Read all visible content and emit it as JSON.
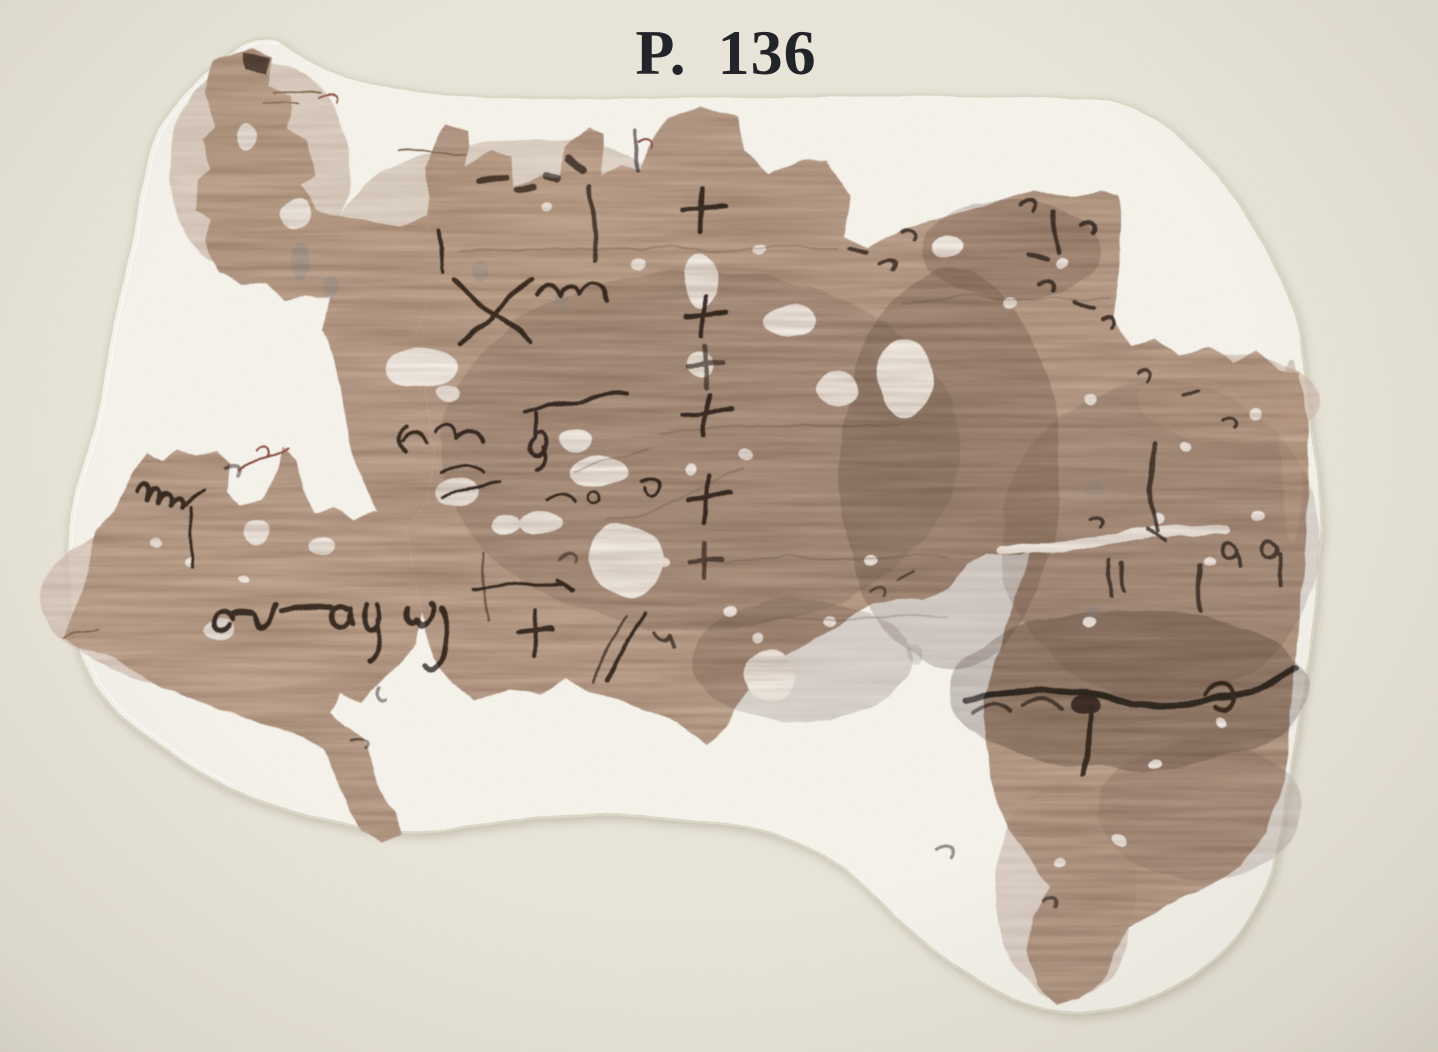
{
  "plate": {
    "title": "P. 136"
  },
  "artifact": {
    "label": "papyrus fragment with greek cursive ink traces",
    "mount_label": "white mounting sheet",
    "background_label": "cream plate paper"
  },
  "colors": {
    "background": "#eae6da",
    "mount": "#f6f4ec",
    "mount_edge": "#dedaca",
    "mount_shadow": "#a9a291",
    "papyrus_base": "#bfa893",
    "papyrus_light": "#cdb69e",
    "papyrus_dark": "#6e5646",
    "ink": "#2e2219",
    "ink_faded": "#6e5b4c",
    "red_fiber": "#9a5340",
    "title_color": "#23232a"
  }
}
